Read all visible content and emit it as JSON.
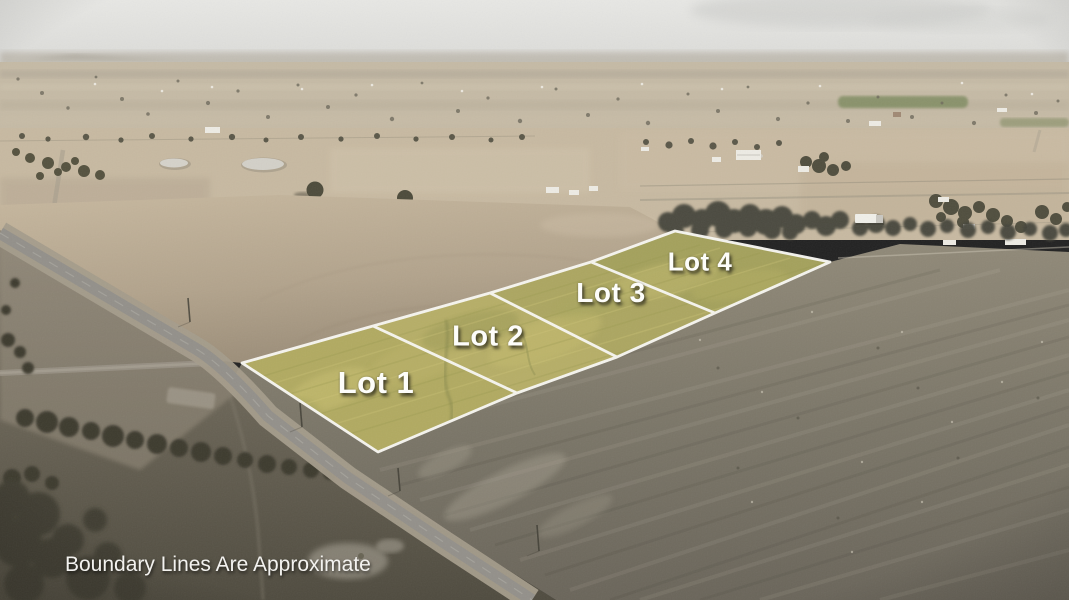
{
  "photo": {
    "kind": "aerial-drone-photo-of-rural-land",
    "palette": {
      "sky": "#e4e4e1",
      "haze_band": "#b9b3a7",
      "distant_fields": "#c5baa5",
      "mid_fields": "#c7b9a1",
      "plowed_field": "#b0a28b",
      "foreground_pasture": "#7b7668",
      "dark_field": "#5a5547",
      "road": "#93908a",
      "trees": "#45443a",
      "green_pasture_far": "#7d8a5f"
    }
  },
  "overlay": {
    "boundary_color": "#f8f7f2",
    "lot_fill": "#afa960",
    "lots": [
      {
        "label": "Lot 1"
      },
      {
        "label": "Lot 2"
      },
      {
        "label": "Lot 3"
      },
      {
        "label": "Lot 4"
      }
    ],
    "disclaimer": "Boundary Lines Are Approximate"
  }
}
